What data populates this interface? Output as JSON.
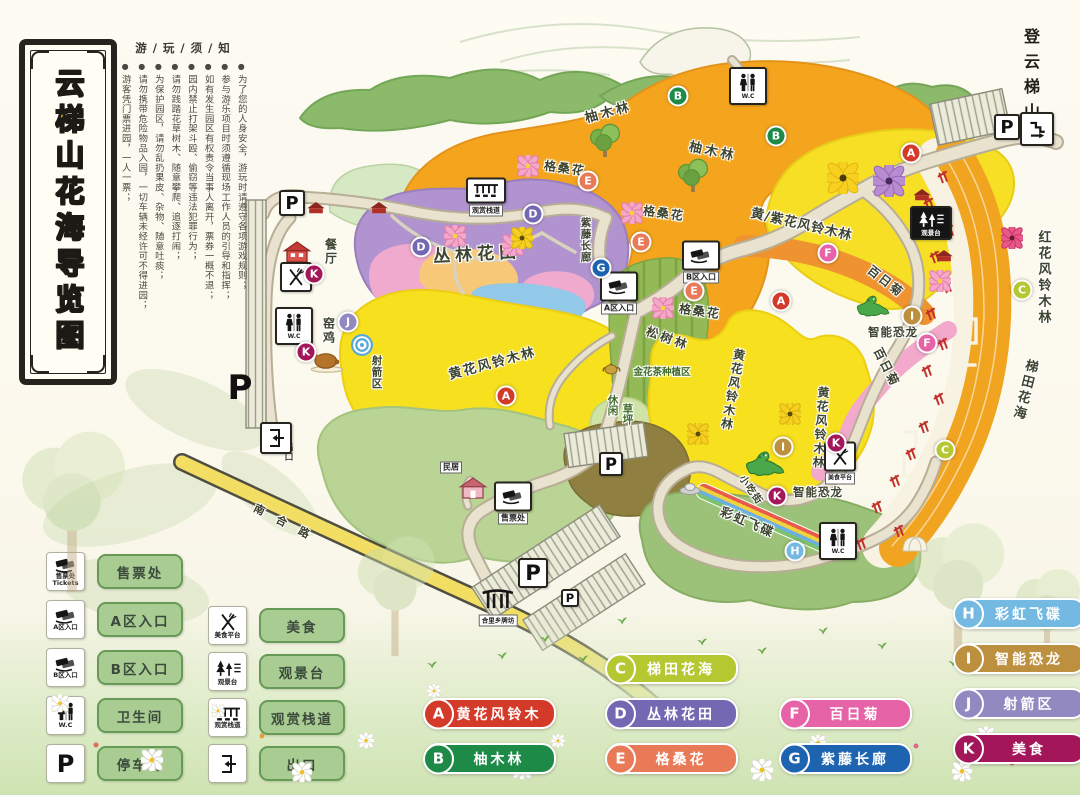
{
  "title": "云梯山花海导览图",
  "notice": {
    "header": "游 / 玩 / 须 / 知",
    "lines": [
      "为了您的人身安全，游玩时请遵守各项游戏规则；",
      "参与游乐项目时须遵循现场工作人员的引导和指挥；",
      "如有发生园区有权责令当事人离开，票券一概不退；",
      "园内禁止打架斗殴、偷窃等违法犯罪行为；",
      "请勿践踏花草树木、随意攀爬、追逐打闹；",
      "为保护园区，请勿乱扔果皮、杂物、随意吐痰；",
      "请勿携带危险物品入园，一切车辆未经许可不得进园；",
      "游客凭门票进园，一人一票；"
    ]
  },
  "summit_label": "登云梯山",
  "legend_icons": {
    "groups": [
      {
        "items": [
          {
            "icon": "ticket",
            "caption": [
              "售票处",
              "Tickets"
            ],
            "label": "售票处"
          },
          {
            "icon": "ticket",
            "caption": [
              "A区入口"
            ],
            "label": "A区入口"
          },
          {
            "icon": "ticket",
            "caption": [
              "B区入口"
            ],
            "label": "B区入口"
          },
          {
            "icon": "wc",
            "caption": [
              "W.C"
            ],
            "label": "卫生间"
          },
          {
            "icon": "p",
            "caption": [],
            "label": "停车场"
          }
        ]
      },
      {
        "items": [
          {
            "icon": "food",
            "caption": [
              "美食平台"
            ],
            "label": "美食"
          },
          {
            "icon": "viewdeck",
            "caption": [
              "观景台"
            ],
            "label": "观景台"
          },
          {
            "icon": "boardwalk",
            "caption": [
              "观赏栈道"
            ],
            "label": "观赏栈道"
          },
          {
            "icon": "exit",
            "caption": [],
            "label": "出口"
          }
        ]
      }
    ]
  },
  "legend_badges": {
    "groups": [
      {
        "items": [
          {
            "letter": "A",
            "label": "黄花风铃木",
            "color": "#d33a2a"
          },
          {
            "letter": "B",
            "label": "柚木林",
            "color": "#1d8a47"
          }
        ]
      },
      {
        "items": [
          {
            "letter": "C",
            "label": "梯田花海",
            "color": "#b5c832"
          },
          {
            "letter": "D",
            "label": "丛林花田",
            "color": "#7568b2"
          },
          {
            "letter": "E",
            "label": "格桑花",
            "color": "#e87a58"
          }
        ]
      },
      {
        "items": [
          {
            "letter": "F",
            "label": "百日菊",
            "color": "#e763a8"
          },
          {
            "letter": "G",
            "label": "紫藤长廊",
            "color": "#1d63b0"
          }
        ]
      },
      {
        "items": [
          {
            "letter": "H",
            "label": "彩虹飞碟",
            "color": "#74b9e2"
          },
          {
            "letter": "I",
            "label": "智能恐龙",
            "color": "#bd9040"
          },
          {
            "letter": "J",
            "label": "射箭区",
            "color": "#9289c1"
          },
          {
            "letter": "K",
            "label": "美食",
            "color": "#a3175a"
          }
        ]
      }
    ]
  },
  "map": {
    "labels": [
      {
        "t": "柚木林",
        "x": 608,
        "y": 111,
        "r": -15,
        "s": 13,
        "ls": 3
      },
      {
        "t": "柚木林",
        "x": 713,
        "y": 150,
        "r": 12,
        "s": 13,
        "ls": 3
      },
      {
        "t": "格桑花",
        "x": 565,
        "y": 168,
        "r": 8,
        "s": 12,
        "ls": 2
      },
      {
        "t": "格桑花",
        "x": 664,
        "y": 213,
        "r": 8,
        "s": 12,
        "ls": 2
      },
      {
        "t": "格桑花",
        "x": 700,
        "y": 311,
        "r": 8,
        "s": 12,
        "ls": 2
      },
      {
        "t": "丛林花田",
        "x": 477,
        "y": 252,
        "r": -3,
        "s": 17,
        "ls": 5
      },
      {
        "t": "黄花风铃木林",
        "x": 492,
        "y": 362,
        "r": -15,
        "s": 13,
        "ls": 2
      },
      {
        "t": "黄花风铃木林",
        "x": 733,
        "y": 390,
        "v": 1,
        "r": 10,
        "s": 12,
        "ls": 2
      },
      {
        "t": "黄花风铃木林",
        "x": 821,
        "y": 428,
        "v": 1,
        "r": 4,
        "s": 12,
        "ls": 2
      },
      {
        "t": "黄/紫花风铃木林",
        "x": 802,
        "y": 223,
        "r": 13,
        "s": 13,
        "ls": 1
      },
      {
        "t": "红花风铃木林",
        "x": 1043,
        "y": 278,
        "v": 1,
        "s": 13,
        "ls": 3
      },
      {
        "t": "百日菊",
        "x": 886,
        "y": 281,
        "r": 38,
        "s": 12,
        "ls": 2
      },
      {
        "t": "百日菊",
        "x": 887,
        "y": 367,
        "r": 63,
        "s": 12,
        "ls": 2
      },
      {
        "t": "智能恐龙",
        "x": 893,
        "y": 332,
        "s": 11.5,
        "ls": 1
      },
      {
        "t": "智能恐龙",
        "x": 818,
        "y": 492,
        "s": 11.5,
        "ls": 1
      },
      {
        "t": "松树林",
        "x": 668,
        "y": 338,
        "r": 20,
        "s": 12,
        "ls": 3
      },
      {
        "t": "金花茶种植区",
        "x": 662,
        "y": 371,
        "s": 9.5,
        "c": "#3f6a28"
      },
      {
        "t": "休闲",
        "x": 613,
        "y": 405,
        "v": 1,
        "s": 10.5,
        "c": "#3f6a28"
      },
      {
        "t": "草坪",
        "x": 628,
        "y": 414,
        "v": 1,
        "s": 10.5,
        "c": "#3f6a28"
      },
      {
        "t": "彩虹飞碟",
        "x": 748,
        "y": 521,
        "r": 23,
        "s": 12.5,
        "ls": 2
      },
      {
        "t": "梯田花海",
        "x": 1024,
        "y": 390,
        "v": 1,
        "r": 14,
        "s": 13,
        "ls": 3
      },
      {
        "t": "小吃街",
        "x": 752,
        "y": 489,
        "r": 55,
        "s": 10,
        "ls": 1
      },
      {
        "t": "紫藤长廊",
        "x": 586,
        "y": 240,
        "v": 1,
        "s": 10.5,
        "ls": 1
      },
      {
        "t": "餐厅",
        "x": 331,
        "y": 252,
        "v": 1,
        "s": 12,
        "ls": 2
      },
      {
        "t": "窑鸡",
        "x": 329,
        "y": 331,
        "v": 1,
        "s": 12,
        "ls": 2
      },
      {
        "t": "射箭区",
        "x": 377,
        "y": 372,
        "v": 1,
        "s": 10.5,
        "ls": 1
      },
      {
        "t": "出口",
        "x": 288,
        "y": 452,
        "v": 1,
        "s": 9,
        "ls": 1
      },
      {
        "t": "南合路",
        "x": 288,
        "y": 524,
        "r": 27,
        "s": 11,
        "ls": 14,
        "c": "#3a3a28"
      }
    ],
    "badges": [
      {
        "l": "A",
        "x": 506,
        "y": 396
      },
      {
        "l": "A",
        "x": 781,
        "y": 301
      },
      {
        "l": "A",
        "x": 911,
        "y": 153
      },
      {
        "l": "B",
        "x": 678,
        "y": 96
      },
      {
        "l": "B",
        "x": 776,
        "y": 136
      },
      {
        "l": "C",
        "x": 1022,
        "y": 290
      },
      {
        "l": "C",
        "x": 945,
        "y": 450
      },
      {
        "l": "D",
        "x": 533,
        "y": 214
      },
      {
        "l": "D",
        "x": 421,
        "y": 247
      },
      {
        "l": "E",
        "x": 588,
        "y": 181
      },
      {
        "l": "E",
        "x": 641,
        "y": 242
      },
      {
        "l": "E",
        "x": 694,
        "y": 291
      },
      {
        "l": "F",
        "x": 828,
        "y": 253
      },
      {
        "l": "F",
        "x": 927,
        "y": 343
      },
      {
        "l": "G",
        "x": 601,
        "y": 268
      },
      {
        "l": "H",
        "x": 795,
        "y": 551
      },
      {
        "l": "I",
        "x": 912,
        "y": 316
      },
      {
        "l": "I",
        "x": 783,
        "y": 447
      },
      {
        "l": "J",
        "x": 348,
        "y": 322
      },
      {
        "l": "K",
        "x": 314,
        "y": 274
      },
      {
        "l": "K",
        "x": 306,
        "y": 352
      },
      {
        "l": "K",
        "x": 836,
        "y": 443
      },
      {
        "l": "K",
        "x": 777,
        "y": 496
      }
    ],
    "signs": [
      {
        "t": "p",
        "x": 292,
        "y": 203,
        "s": 22
      },
      {
        "t": "p-plain",
        "x": 240,
        "y": 388,
        "s": 34
      },
      {
        "t": "p",
        "x": 1007,
        "y": 127,
        "s": 22
      },
      {
        "t": "p",
        "x": 611,
        "y": 464,
        "s": 20
      },
      {
        "t": "p",
        "x": 533,
        "y": 573,
        "s": 26
      },
      {
        "t": "p",
        "x": 570,
        "y": 598,
        "s": 14
      },
      {
        "t": "wc",
        "x": 294,
        "y": 326
      },
      {
        "t": "wc",
        "x": 748,
        "y": 86
      },
      {
        "t": "wc",
        "x": 838,
        "y": 541
      },
      {
        "t": "entrance",
        "x": 619,
        "y": 293,
        "lab": "A区入口"
      },
      {
        "t": "entrance",
        "x": 701,
        "y": 262,
        "lab": "B区入口"
      },
      {
        "t": "ticket",
        "x": 513,
        "y": 503,
        "lab": "售票处"
      },
      {
        "t": "exit",
        "x": 276,
        "y": 438
      },
      {
        "t": "boardwalk",
        "x": 486,
        "y": 197,
        "lab": "观赏栈道"
      },
      {
        "t": "viewdeck",
        "x": 931,
        "y": 223,
        "lab": "观景台"
      },
      {
        "t": "food",
        "x": 296,
        "y": 277,
        "lab": ""
      },
      {
        "t": "food",
        "x": 840,
        "y": 463,
        "lab": "美食平台"
      },
      {
        "t": "gate",
        "x": 498,
        "y": 607,
        "lab": "合里乡牌坊"
      },
      {
        "t": "slide",
        "x": 1037,
        "y": 129
      },
      {
        "t": "label-box",
        "x": 451,
        "y": 467,
        "lab": "民居"
      }
    ],
    "decor": [
      {
        "t": "tree",
        "x": 605,
        "y": 142
      },
      {
        "t": "tree",
        "x": 693,
        "y": 177
      },
      {
        "t": "dino",
        "x": 873,
        "y": 308,
        "k": 0.85
      },
      {
        "t": "dino",
        "x": 765,
        "y": 466,
        "k": 1
      },
      {
        "t": "chicken",
        "x": 327,
        "y": 363
      },
      {
        "t": "target",
        "x": 362,
        "y": 347
      },
      {
        "t": "teapot",
        "x": 612,
        "y": 369
      },
      {
        "t": "house-red",
        "x": 297,
        "y": 254
      },
      {
        "t": "house-pink",
        "x": 473,
        "y": 490
      },
      {
        "t": "redbldg",
        "x": 316,
        "y": 209
      },
      {
        "t": "redbldg",
        "x": 379,
        "y": 209
      },
      {
        "t": "redbldg",
        "x": 922,
        "y": 196
      },
      {
        "t": "redbldg",
        "x": 944,
        "y": 257
      },
      {
        "t": "ufo",
        "x": 690,
        "y": 490
      },
      {
        "t": "rainbow",
        "x": 766,
        "y": 519
      },
      {
        "t": "dome",
        "x": 915,
        "y": 545
      },
      {
        "t": "flower",
        "x": 528,
        "y": 168,
        "c": "pink"
      },
      {
        "t": "flower",
        "x": 632,
        "y": 215,
        "c": "pink"
      },
      {
        "t": "flower",
        "x": 663,
        "y": 310,
        "c": "pink"
      },
      {
        "t": "flower",
        "x": 455,
        "y": 238,
        "c": "pink"
      },
      {
        "t": "flower",
        "x": 513,
        "y": 247,
        "c": "pink"
      },
      {
        "t": "flower",
        "x": 940,
        "y": 283,
        "c": "pink"
      },
      {
        "t": "flower",
        "x": 1012,
        "y": 240,
        "c": "red"
      },
      {
        "t": "flower",
        "x": 843,
        "y": 180,
        "c": "yellowbig"
      },
      {
        "t": "flower",
        "x": 889,
        "y": 183,
        "c": "purplebig"
      },
      {
        "t": "flower",
        "x": 698,
        "y": 436,
        "c": "yellow"
      },
      {
        "t": "flower",
        "x": 790,
        "y": 416,
        "c": "yellow"
      },
      {
        "t": "flower",
        "x": 522,
        "y": 240,
        "c": "yellow"
      }
    ]
  }
}
